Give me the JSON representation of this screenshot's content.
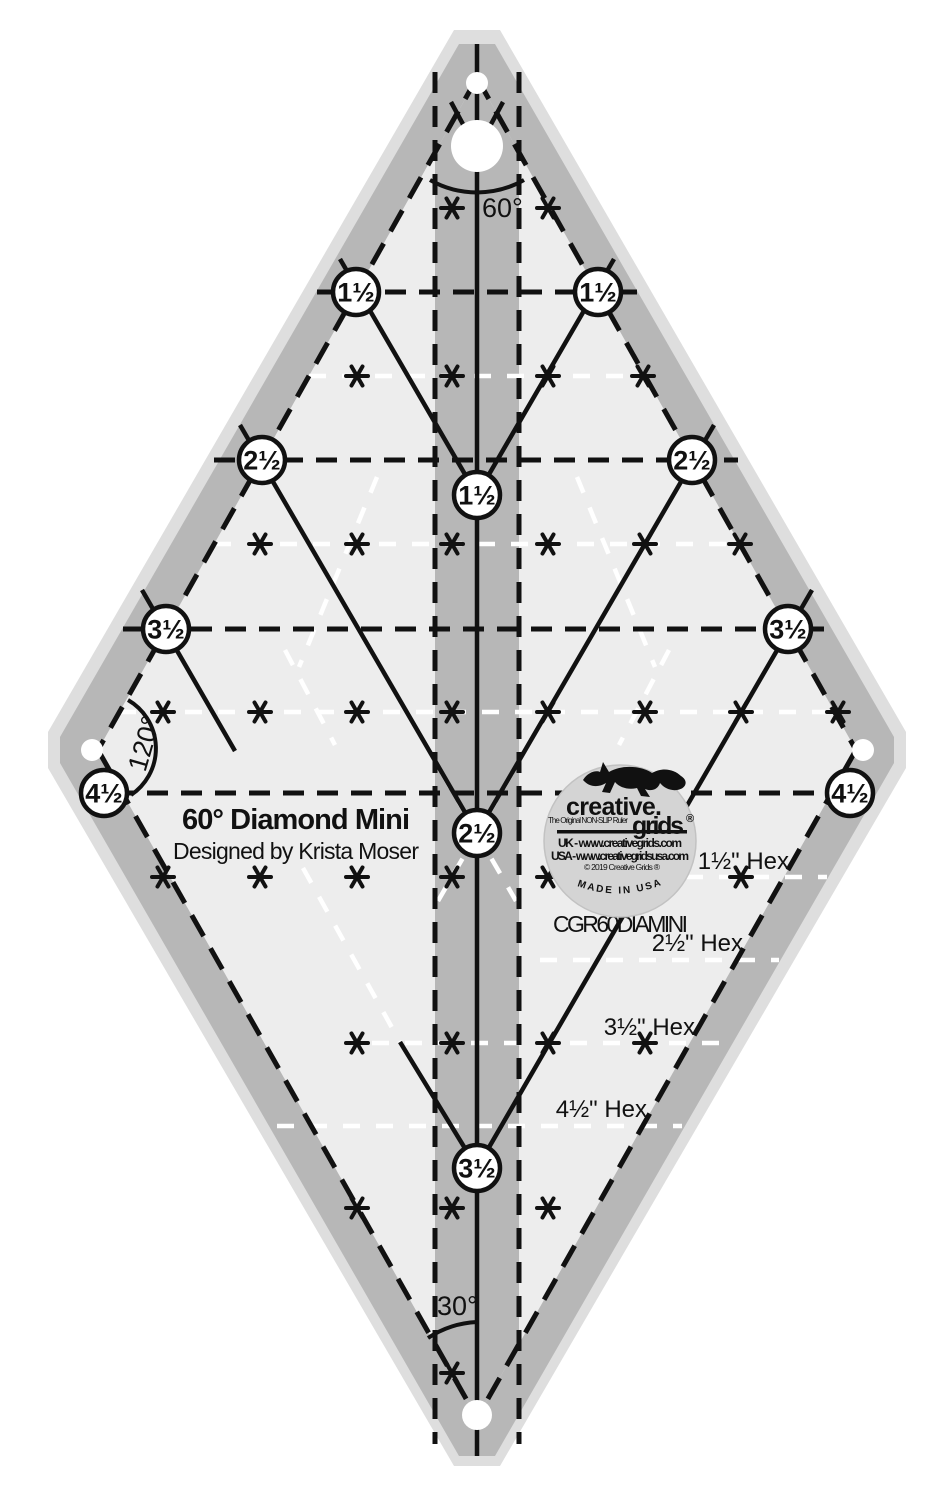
{
  "ruler": {
    "title": "60° Diamond Mini",
    "subtitle": "Designed by Krista Moser",
    "product_code": "CGR60DIAMINI",
    "angles": {
      "top": "60°",
      "left": "120°",
      "bottom": "30°"
    },
    "sizes": {
      "d15": "1½",
      "d25": "2½",
      "d35": "3½",
      "d45": "4½"
    },
    "size_circle_labels": [
      "1½",
      "1½",
      "2½",
      "2½",
      "3½",
      "3½",
      "4½",
      "4½",
      "1½",
      "2½",
      "3½"
    ],
    "hex_labels": [
      "1½\" Hex",
      "2½\" Hex",
      "3½\" Hex",
      "4½\" Hex"
    ],
    "colors": {
      "body_gray": "#b7b7b7",
      "interior_gray": "#ededed",
      "edge_highlight": "#dedede",
      "markings_black": "#111111",
      "markings_white": "#ffffff",
      "logo_background": "#d4d4d4"
    }
  },
  "logo": {
    "brand_top": "creative.",
    "brand_bottom": "grids",
    "registered": "®",
    "tagline": "The Original NON-SLIP Ruler",
    "uk_line": "UK - www.creativegrids.com",
    "usa_line": "USA - www.creativegridsusa.com",
    "copyright": "© 2019 Creative Grids ®",
    "made_in": "MADE IN USA"
  }
}
